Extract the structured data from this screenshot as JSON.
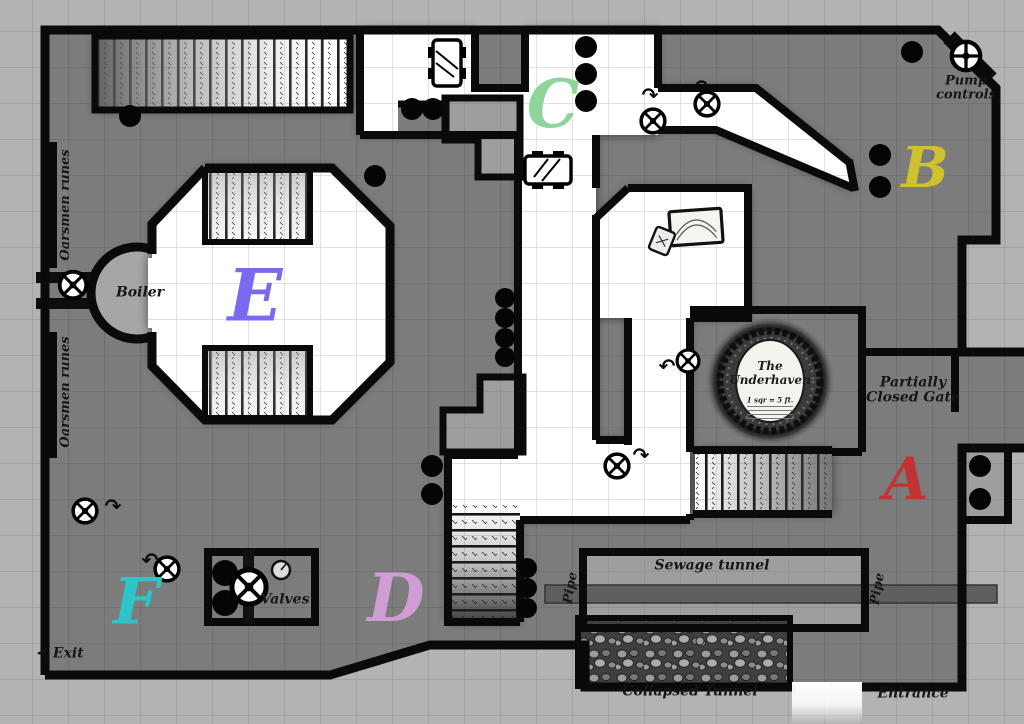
{
  "map": {
    "title": "The Underhaven",
    "scale_note": "1 sqr = 5 ft.",
    "regions": [
      {
        "letter": "A",
        "color": "#c23434"
      },
      {
        "letter": "B",
        "color": "#cfc22e"
      },
      {
        "letter": "C",
        "color": "#8fd49a"
      },
      {
        "letter": "D",
        "color": "#cf9cd4"
      },
      {
        "letter": "E",
        "color": "#7a6af0"
      },
      {
        "letter": "F",
        "color": "#2cc6c9"
      }
    ],
    "labels": {
      "pump_controls": "Pump controls",
      "oarsmen_runes": "Oarsmen runes",
      "boiler": "Boiler",
      "partially_closed_gate": "Partially Closed Gate",
      "sewage_tunnel": "Sewage tunnel",
      "pipe": "Pipe",
      "valves": "Valves",
      "exit": "< Exit",
      "collapsed_tunnel": "Collapsed Tunnel",
      "entrance": "Entrance"
    },
    "arrows": {
      "cw": "↷",
      "ccw": "↶"
    },
    "colors": {
      "wall": "#0a0a0a",
      "floor_dark": "#7c7c7c",
      "floor_light": "#ffffff",
      "floor_mid": "#9e9e9e",
      "outside": "#b3b3b3"
    }
  }
}
